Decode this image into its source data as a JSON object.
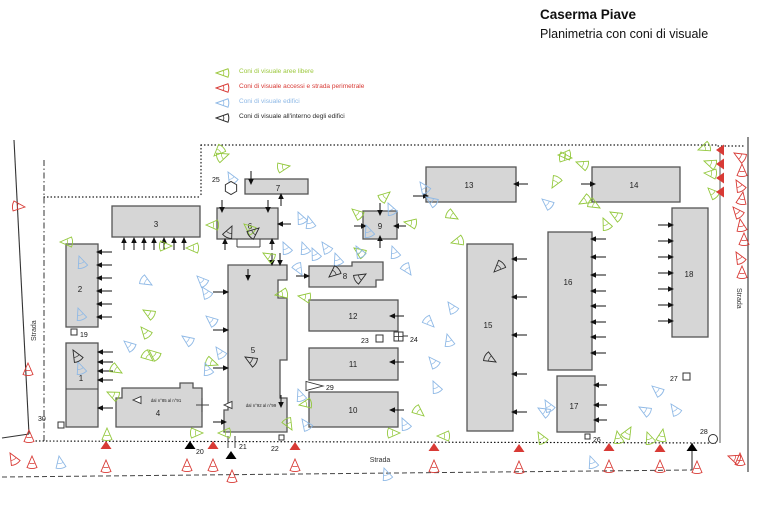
{
  "title": {
    "line1": "Caserma Piave",
    "line2": "Planimetria con coni di visuale"
  },
  "legend": {
    "items": [
      {
        "label": "Coni di visuale aree libere",
        "color": "#9cc83d"
      },
      {
        "label": "Coni di visuale accessi e strada perimetrale",
        "color": "#d83a35"
      },
      {
        "label": "Coni di visuale edifici",
        "color": "#8fb9e6"
      },
      {
        "label": "Coni di visuale all'interno degli edifici",
        "color": "#2b2b2b"
      }
    ]
  },
  "palette": {
    "building_fill": "#d6d6d6",
    "building_stroke": "#555555",
    "green": "#93c83d",
    "blue": "#8fb9e6",
    "red": "#d83a35",
    "black": "#2b2b2b",
    "line": "#333333",
    "text": "#1a1a1a"
  },
  "roads": {
    "labels": [
      {
        "text": "Strada",
        "x": 36,
        "y": 341,
        "rotate": -90
      },
      {
        "text": "Strada",
        "x": 737,
        "y": 288,
        "rotate": 90
      },
      {
        "text": "Strada",
        "x": 380,
        "y": 462,
        "rotate": 0
      }
    ]
  },
  "buildings": [
    {
      "id": "1",
      "label": "1",
      "rect": [
        66,
        343,
        32,
        84
      ],
      "lx": 81,
      "ly": 381
    },
    {
      "id": "2",
      "label": "2",
      "rect": [
        66,
        244,
        32,
        83
      ],
      "lx": 80,
      "ly": 292
    },
    {
      "id": "3",
      "label": "3",
      "rect": [
        112,
        206,
        88,
        31
      ],
      "lx": 156,
      "ly": 227
    },
    {
      "id": "4",
      "label": "4",
      "poly": "122,388 180,388 180,383 193,383 193,388 202,388 202,427 116,427 116,398 122,398",
      "lx": 158,
      "ly": 416
    },
    {
      "id": "5",
      "label": "5",
      "poly": "228,265 287,265 287,280 278,280 278,298 287,298 287,360 280,360 280,398 287,398 287,432 224,432 224,410 228,410",
      "lx": 253,
      "ly": 353
    },
    {
      "id": "6",
      "label": "6",
      "rect": [
        217,
        208,
        61,
        31
      ],
      "lx": 250,
      "ly": 229
    },
    {
      "id": "7",
      "label": "7",
      "rect": [
        245,
        179,
        63,
        15
      ],
      "lx": 278,
      "ly": 191
    },
    {
      "id": "8",
      "label": "8",
      "poly": "309,266 352,266 352,262 383,262 383,280 376,280 376,287 309,287",
      "lx": 345,
      "ly": 279
    },
    {
      "id": "9",
      "label": "9",
      "rect": [
        363,
        211,
        34,
        28
      ],
      "lx": 380,
      "ly": 229
    },
    {
      "id": "10",
      "label": "10",
      "rect": [
        309,
        392,
        89,
        35
      ],
      "lx": 353,
      "ly": 413
    },
    {
      "id": "11",
      "label": "11",
      "rect": [
        309,
        348,
        89,
        32
      ],
      "lx": 353,
      "ly": 367
    },
    {
      "id": "12",
      "label": "12",
      "rect": [
        309,
        300,
        89,
        31
      ],
      "lx": 353,
      "ly": 319
    },
    {
      "id": "13",
      "label": "13",
      "rect": [
        426,
        167,
        90,
        35
      ],
      "lx": 469,
      "ly": 188
    },
    {
      "id": "14",
      "label": "14",
      "rect": [
        592,
        167,
        88,
        35
      ],
      "lx": 634,
      "ly": 188
    },
    {
      "id": "15",
      "label": "15",
      "rect": [
        467,
        244,
        46,
        187
      ],
      "lx": 488,
      "ly": 328
    },
    {
      "id": "16",
      "label": "16",
      "rect": [
        548,
        232,
        44,
        138
      ],
      "lx": 568,
      "ly": 285
    },
    {
      "id": "17",
      "label": "17",
      "rect": [
        557,
        376,
        38,
        56
      ],
      "lx": 574,
      "ly": 409
    },
    {
      "id": "18",
      "label": "18",
      "rect": [
        672,
        208,
        36,
        129
      ],
      "lx": 689,
      "ly": 277
    }
  ],
  "inner_texts": [
    {
      "t": "dal n°85 al n°91",
      "x": 166,
      "y": 402,
      "size": 4.3
    },
    {
      "t": "dal n°92 al n°99",
      "x": 261,
      "y": 407,
      "size": 4.3
    }
  ],
  "boundary_lines": [
    {
      "p": [
        201,
        145,
        718,
        145
      ],
      "s": "dot"
    },
    {
      "p": [
        718,
        146,
        746,
        146
      ],
      "s": "dot"
    },
    {
      "p": [
        201,
        145,
        201,
        196
      ],
      "s": "dot"
    },
    {
      "p": [
        44,
        197,
        201,
        197
      ],
      "s": "dot"
    },
    {
      "p": [
        44,
        160,
        44,
        441
      ],
      "s": "dashdot"
    },
    {
      "p": [
        36,
        441,
        716,
        443
      ],
      "s": "dot"
    },
    {
      "p": [
        14,
        140,
        29,
        434
      ],
      "s": "solid"
    },
    {
      "p": [
        29,
        434,
        2,
        438
      ],
      "s": "solid"
    },
    {
      "p": [
        2,
        477,
        692,
        470
      ],
      "s": "dash"
    },
    {
      "p": [
        692,
        443,
        692,
        470
      ],
      "s": "solid"
    },
    {
      "p": [
        720,
        147,
        720,
        443
      ],
      "s": "solidgray"
    },
    {
      "p": [
        748,
        137,
        748,
        472
      ],
      "s": "solid"
    }
  ],
  "extra_lines": [
    [
      66,
      389,
      98,
      389
    ],
    [
      237,
      239,
      237,
      247
    ],
    [
      237,
      247,
      260,
      247
    ],
    [
      260,
      239,
      260,
      247
    ],
    [
      228,
      436,
      228,
      448
    ],
    [
      235,
      436,
      235,
      448
    ],
    [
      196,
      405,
      209,
      405
    ],
    [
      202,
      398,
      202,
      412
    ]
  ],
  "view_arrows": [
    [
      97,
      352,
      180,
      16
    ],
    [
      97,
      362,
      180,
      16
    ],
    [
      97,
      371,
      180,
      16
    ],
    [
      97,
      380,
      180,
      16
    ],
    [
      97,
      408,
      180,
      16
    ],
    [
      96,
      252,
      180,
      16
    ],
    [
      96,
      265,
      180,
      16
    ],
    [
      96,
      278,
      180,
      16
    ],
    [
      96,
      291,
      180,
      16
    ],
    [
      96,
      304,
      180,
      16
    ],
    [
      96,
      317,
      180,
      16
    ],
    [
      124,
      237,
      270,
      13
    ],
    [
      134,
      237,
      270,
      13
    ],
    [
      144,
      237,
      270,
      13
    ],
    [
      154,
      237,
      270,
      13
    ],
    [
      164,
      237,
      270,
      13
    ],
    [
      174,
      237,
      270,
      13
    ],
    [
      184,
      237,
      270,
      13
    ],
    [
      229,
      292,
      0,
      16
    ],
    [
      229,
      330,
      0,
      16
    ],
    [
      229,
      368,
      0,
      16
    ],
    [
      227,
      422,
      0,
      14
    ],
    [
      272,
      266,
      90,
      13
    ],
    [
      280,
      266,
      90,
      13
    ],
    [
      248,
      281,
      90,
      12
    ],
    [
      281,
      408,
      90,
      13
    ],
    [
      222,
      213,
      90,
      13
    ],
    [
      268,
      213,
      90,
      13
    ],
    [
      225,
      238,
      270,
      12
    ],
    [
      272,
      238,
      270,
      12
    ],
    [
      277,
      224,
      180,
      14
    ],
    [
      251,
      185,
      90,
      14
    ],
    [
      281,
      193,
      270,
      13
    ],
    [
      310,
      276,
      0,
      14
    ],
    [
      380,
      216,
      90,
      13
    ],
    [
      380,
      235,
      270,
      13
    ],
    [
      367,
      226,
      0,
      13
    ],
    [
      393,
      226,
      180,
      13
    ],
    [
      429,
      196,
      0,
      16
    ],
    [
      513,
      184,
      180,
      15
    ],
    [
      596,
      184,
      0,
      15
    ],
    [
      389,
      316,
      180,
      15
    ],
    [
      389,
      362,
      180,
      15
    ],
    [
      389,
      410,
      180,
      15
    ],
    [
      511,
      259,
      180,
      16
    ],
    [
      511,
      297,
      180,
      16
    ],
    [
      511,
      335,
      180,
      16
    ],
    [
      511,
      374,
      180,
      16
    ],
    [
      511,
      412,
      180,
      16
    ],
    [
      590,
      239,
      180,
      16
    ],
    [
      590,
      257,
      180,
      16
    ],
    [
      590,
      275,
      180,
      16
    ],
    [
      590,
      291,
      180,
      16
    ],
    [
      590,
      306,
      180,
      16
    ],
    [
      590,
      322,
      180,
      16
    ],
    [
      590,
      337,
      180,
      16
    ],
    [
      590,
      353,
      180,
      16
    ],
    [
      593,
      385,
      180,
      14
    ],
    [
      593,
      405,
      180,
      14
    ],
    [
      593,
      420,
      180,
      14
    ],
    [
      674,
      225,
      0,
      16
    ],
    [
      674,
      241,
      0,
      16
    ],
    [
      674,
      257,
      0,
      16
    ],
    [
      674,
      273,
      0,
      16
    ],
    [
      674,
      289,
      0,
      16
    ],
    [
      674,
      305,
      0,
      16
    ],
    [
      674,
      321,
      0,
      16
    ]
  ],
  "gates": [
    [
      106,
      449,
      "u",
      "r"
    ],
    [
      190,
      449,
      "u",
      "k"
    ],
    [
      213,
      449,
      "u",
      "r"
    ],
    [
      231,
      459,
      "u",
      "k"
    ],
    [
      295,
      450,
      "u",
      "r"
    ],
    [
      434,
      451,
      "u",
      "r"
    ],
    [
      519,
      452,
      "u",
      "r"
    ],
    [
      609,
      451,
      "u",
      "r"
    ],
    [
      660,
      452,
      "u",
      "r"
    ],
    [
      692,
      451,
      "u",
      "k"
    ],
    [
      724,
      150,
      "l",
      "r"
    ],
    [
      724,
      164,
      "l",
      "r"
    ],
    [
      724,
      178,
      "l",
      "r"
    ],
    [
      724,
      192,
      "l",
      "r"
    ]
  ],
  "markers": [
    {
      "label": "19",
      "lx": 80,
      "ly": 337,
      "shape": "square",
      "sx": 71,
      "sy": 329,
      "size": 6
    },
    {
      "label": "20",
      "lx": 196,
      "ly": 454
    },
    {
      "label": "21",
      "lx": 239,
      "ly": 449
    },
    {
      "label": "22",
      "lx": 271,
      "ly": 451,
      "shape": "square",
      "sx": 279,
      "sy": 435,
      "size": 5
    },
    {
      "label": "23",
      "lx": 361,
      "ly": 343,
      "shape": "square",
      "sx": 376,
      "sy": 335,
      "size": 7
    },
    {
      "label": "24",
      "lx": 410,
      "ly": 342,
      "shape": "sqcross",
      "sx": 394,
      "sy": 332,
      "size": 9,
      "line": [
        403,
        336,
        408,
        336
      ]
    },
    {
      "label": "25",
      "lx": 212,
      "ly": 182,
      "shape": "hexagon",
      "sx": 231,
      "sy": 188,
      "size": 6.5
    },
    {
      "label": "26",
      "lx": 593,
      "ly": 442,
      "shape": "square",
      "sx": 585,
      "sy": 434,
      "size": 5
    },
    {
      "label": "27",
      "lx": 670,
      "ly": 381,
      "shape": "square",
      "sx": 683,
      "sy": 373,
      "size": 7
    },
    {
      "label": "28",
      "lx": 700,
      "ly": 434,
      "shape": "circle",
      "sx": 713,
      "sy": 439,
      "size": 4.5
    },
    {
      "label": "29",
      "lx": 326,
      "ly": 390,
      "shape": "pennant",
      "sx": 306,
      "sy": 386,
      "size": 9
    },
    {
      "label": "30",
      "lx": 38,
      "ly": 421,
      "shape": "square",
      "sx": 58,
      "sy": 422,
      "size": 6
    },
    {
      "label": "",
      "shape": "tri-left",
      "sx": 133,
      "sy": 400,
      "size": 8
    },
    {
      "label": "",
      "shape": "tri-left",
      "sx": 224,
      "sy": 405,
      "size": 8
    }
  ],
  "cones": {
    "g": [
      [
        214,
        156,
        315
      ],
      [
        229,
        154,
        160
      ],
      [
        290,
        166,
        170
      ],
      [
        206,
        225,
        0
      ],
      [
        244,
        224,
        40
      ],
      [
        263,
        253,
        30
      ],
      [
        60,
        242,
        0
      ],
      [
        172,
        246,
        180
      ],
      [
        186,
        248,
        0
      ],
      [
        143,
        310,
        30
      ],
      [
        141,
        327,
        50
      ],
      [
        149,
        350,
        40
      ],
      [
        153,
        361,
        220
      ],
      [
        218,
        365,
        200
      ],
      [
        122,
        373,
        210
      ],
      [
        107,
        392,
        25
      ],
      [
        107,
        428,
        90
      ],
      [
        203,
        433,
        180
      ],
      [
        218,
        433,
        0
      ],
      [
        275,
        295,
        350
      ],
      [
        298,
        296,
        10
      ],
      [
        299,
        405,
        350
      ],
      [
        292,
        430,
        240
      ],
      [
        354,
        248,
        35
      ],
      [
        352,
        209,
        40
      ],
      [
        404,
        222,
        10
      ],
      [
        451,
        243,
        345
      ],
      [
        458,
        219,
        210
      ],
      [
        424,
        416,
        220
      ],
      [
        400,
        433,
        180
      ],
      [
        437,
        436,
        0
      ],
      [
        538,
        432,
        60
      ],
      [
        617,
        431,
        80
      ],
      [
        631,
        427,
        120
      ],
      [
        647,
        432,
        70
      ],
      [
        663,
        429,
        100
      ],
      [
        552,
        188,
        300
      ],
      [
        579,
        204,
        330
      ],
      [
        600,
        208,
        210
      ],
      [
        610,
        212,
        30
      ],
      [
        603,
        218,
        65
      ],
      [
        576,
        162,
        20
      ],
      [
        558,
        155,
        0
      ],
      [
        572,
        158,
        185
      ],
      [
        390,
        192,
        140
      ],
      [
        698,
        150,
        340
      ],
      [
        704,
        161,
        20
      ],
      [
        704,
        173,
        5
      ],
      [
        708,
        188,
        45
      ]
    ],
    "b": [
      [
        228,
        172,
        60
      ],
      [
        152,
        285,
        210
      ],
      [
        197,
        276,
        45
      ],
      [
        202,
        287,
        55
      ],
      [
        124,
        341,
        40
      ],
      [
        182,
        336,
        35
      ],
      [
        206,
        316,
        40
      ],
      [
        216,
        347,
        55
      ],
      [
        205,
        363,
        70
      ],
      [
        79,
        256,
        70
      ],
      [
        78,
        308,
        70
      ],
      [
        78,
        362,
        70
      ],
      [
        298,
        212,
        65
      ],
      [
        308,
        216,
        75
      ],
      [
        283,
        242,
        65
      ],
      [
        302,
        242,
        70
      ],
      [
        312,
        248,
        65
      ],
      [
        322,
        242,
        55
      ],
      [
        335,
        253,
        70
      ],
      [
        356,
        246,
        60
      ],
      [
        302,
        275,
        240
      ],
      [
        366,
        225,
        70
      ],
      [
        388,
        203,
        65
      ],
      [
        392,
        246,
        70
      ],
      [
        411,
        275,
        235
      ],
      [
        420,
        182,
        55
      ],
      [
        426,
        197,
        35
      ],
      [
        434,
        327,
        225
      ],
      [
        447,
        334,
        75
      ],
      [
        429,
        357,
        50
      ],
      [
        433,
        381,
        65
      ],
      [
        402,
        418,
        65
      ],
      [
        298,
        389,
        70
      ],
      [
        302,
        419,
        55
      ],
      [
        448,
        302,
        55
      ],
      [
        542,
        199,
        40
      ],
      [
        652,
        386,
        40
      ],
      [
        671,
        404,
        55
      ],
      [
        639,
        407,
        30
      ],
      [
        538,
        408,
        30
      ],
      [
        545,
        400,
        60
      ],
      [
        590,
        456,
        70
      ],
      [
        384,
        468,
        70
      ],
      [
        59,
        456,
        80
      ]
    ],
    "k": [
      [
        73,
        350,
        60
      ],
      [
        232,
        226,
        115
      ],
      [
        259,
        228,
        140
      ],
      [
        329,
        277,
        320
      ],
      [
        366,
        274,
        150
      ],
      [
        245,
        357,
        30
      ],
      [
        494,
        272,
        315
      ],
      [
        496,
        362,
        210
      ]
    ],
    "r": [
      [
        25,
        207,
        185
      ],
      [
        28,
        363,
        90
      ],
      [
        29,
        430,
        90
      ],
      [
        10,
        453,
        60
      ],
      [
        32,
        456,
        90
      ],
      [
        106,
        460,
        90
      ],
      [
        187,
        459,
        90
      ],
      [
        213,
        459,
        90
      ],
      [
        232,
        470,
        90
      ],
      [
        295,
        459,
        90
      ],
      [
        434,
        460,
        90
      ],
      [
        519,
        461,
        90
      ],
      [
        609,
        460,
        90
      ],
      [
        660,
        460,
        90
      ],
      [
        697,
        461,
        90
      ],
      [
        728,
        456,
        20
      ],
      [
        740,
        453,
        90
      ],
      [
        734,
        153,
        30
      ],
      [
        742,
        164,
        90
      ],
      [
        736,
        180,
        60
      ],
      [
        743,
        192,
        100
      ],
      [
        733,
        207,
        50
      ],
      [
        740,
        219,
        80
      ],
      [
        744,
        233,
        90
      ],
      [
        736,
        252,
        60
      ],
      [
        742,
        266,
        90
      ]
    ]
  }
}
